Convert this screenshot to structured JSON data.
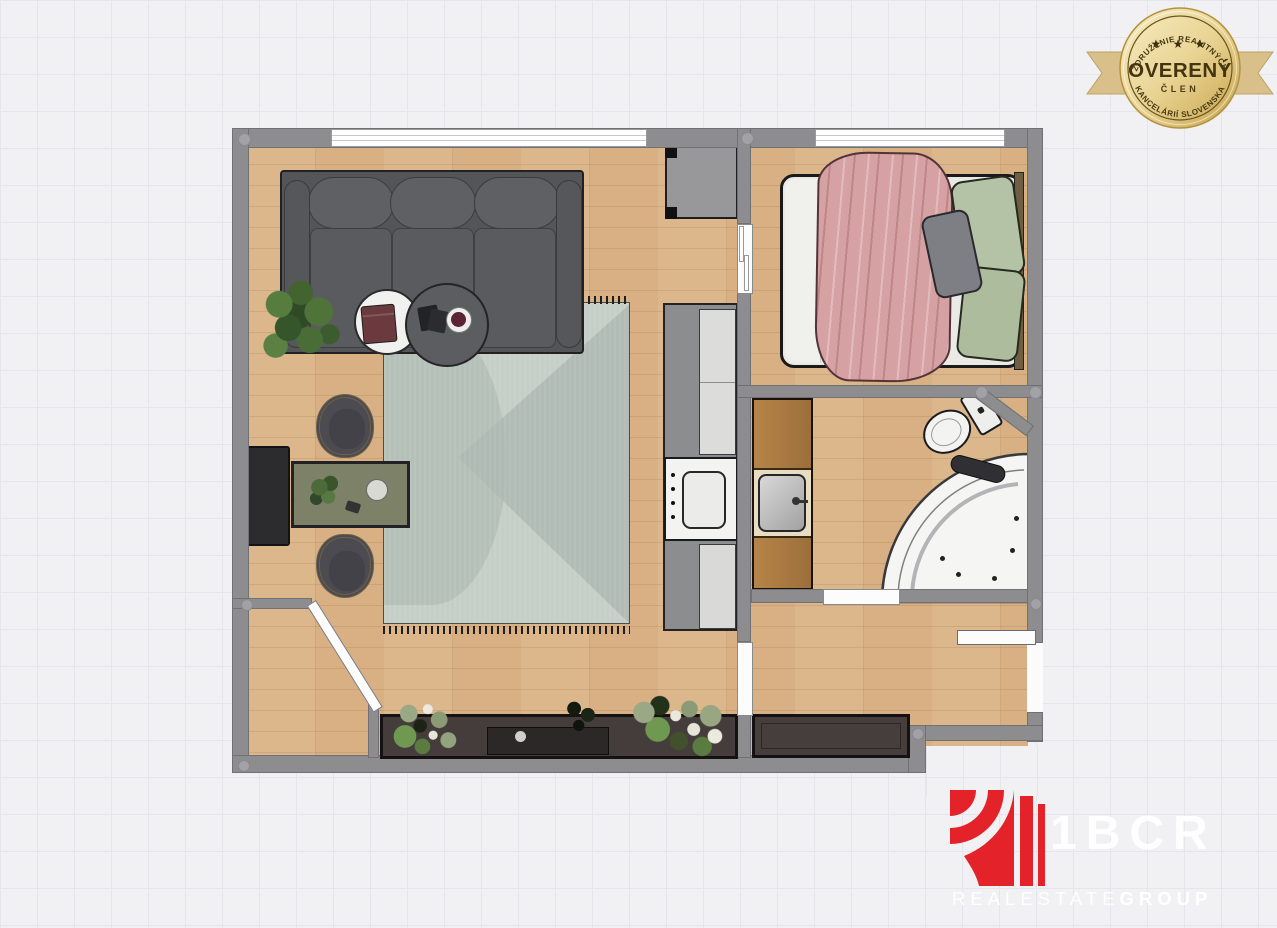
{
  "badge": {
    "arc_top": "ZDRUŽENIE REALITNÝCH",
    "stars": "★ ★ ★",
    "title": "OVERENÝ",
    "subtitle": "ČLEN",
    "arc_bottom": "KANCELÁRIÍ SLOVENSKA"
  },
  "logo": {
    "brand": "1BCR",
    "real": "REAL",
    "estate": "ESTATE",
    "group": "GROUP"
  },
  "colors": {
    "wall": "#8d8d90",
    "floor_wood": "#d8b083",
    "rug_sage": "#c5cec7",
    "sofa_gray": "#57595c",
    "blanket_pink": "#d6a1a3",
    "pillow_green": "#b4c2a6",
    "vanity_wood": "#ad7b41",
    "accent_red": "#e32229",
    "badge_gold": "#d9c08a"
  }
}
